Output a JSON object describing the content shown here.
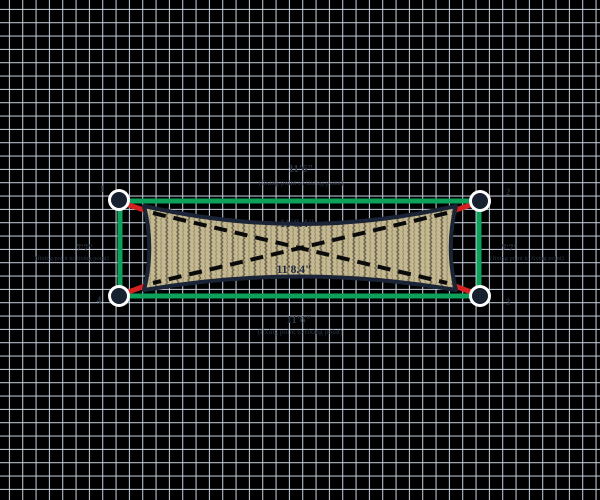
{
  "app": {
    "name": "shade sail design canvas"
  },
  "colors": {
    "background": "#000000",
    "grid_line": "#c9d2e0",
    "perimeter_green": "#0da15b",
    "connector_red": "#d42222",
    "fixing_point_fill": "#16202f",
    "fixing_point_ring": "#ffffff",
    "fabric_base": "#c7ba92",
    "fabric_weave": "#6e6751",
    "fabric_border": "#1b2436",
    "diagonal_dash": "#0a0a0a",
    "dimension_text": "#2b3546",
    "diagonal_text": "#1d2638"
  },
  "dimensions": {
    "top": {
      "value": "11'6\"",
      "note": "(fixing point to fixing point)"
    },
    "bottom": {
      "value": "11'6\"",
      "note": "(fixing point to fixing point)"
    },
    "left": {
      "value": "7'7\"",
      "note": "(fixing point to fixing point)"
    },
    "right": {
      "value": "7'7\"",
      "note": "(fixing point to fixing point)"
    },
    "diagonal_1": "11'8.4\"",
    "diagonal_2": "11'8.4\""
  },
  "fixing_points": [
    {
      "label": "1",
      "position": "top-left"
    },
    {
      "label": "2",
      "position": "top-right"
    },
    {
      "label": "3",
      "position": "bottom-right"
    },
    {
      "label": "4",
      "position": "bottom-left"
    }
  ]
}
